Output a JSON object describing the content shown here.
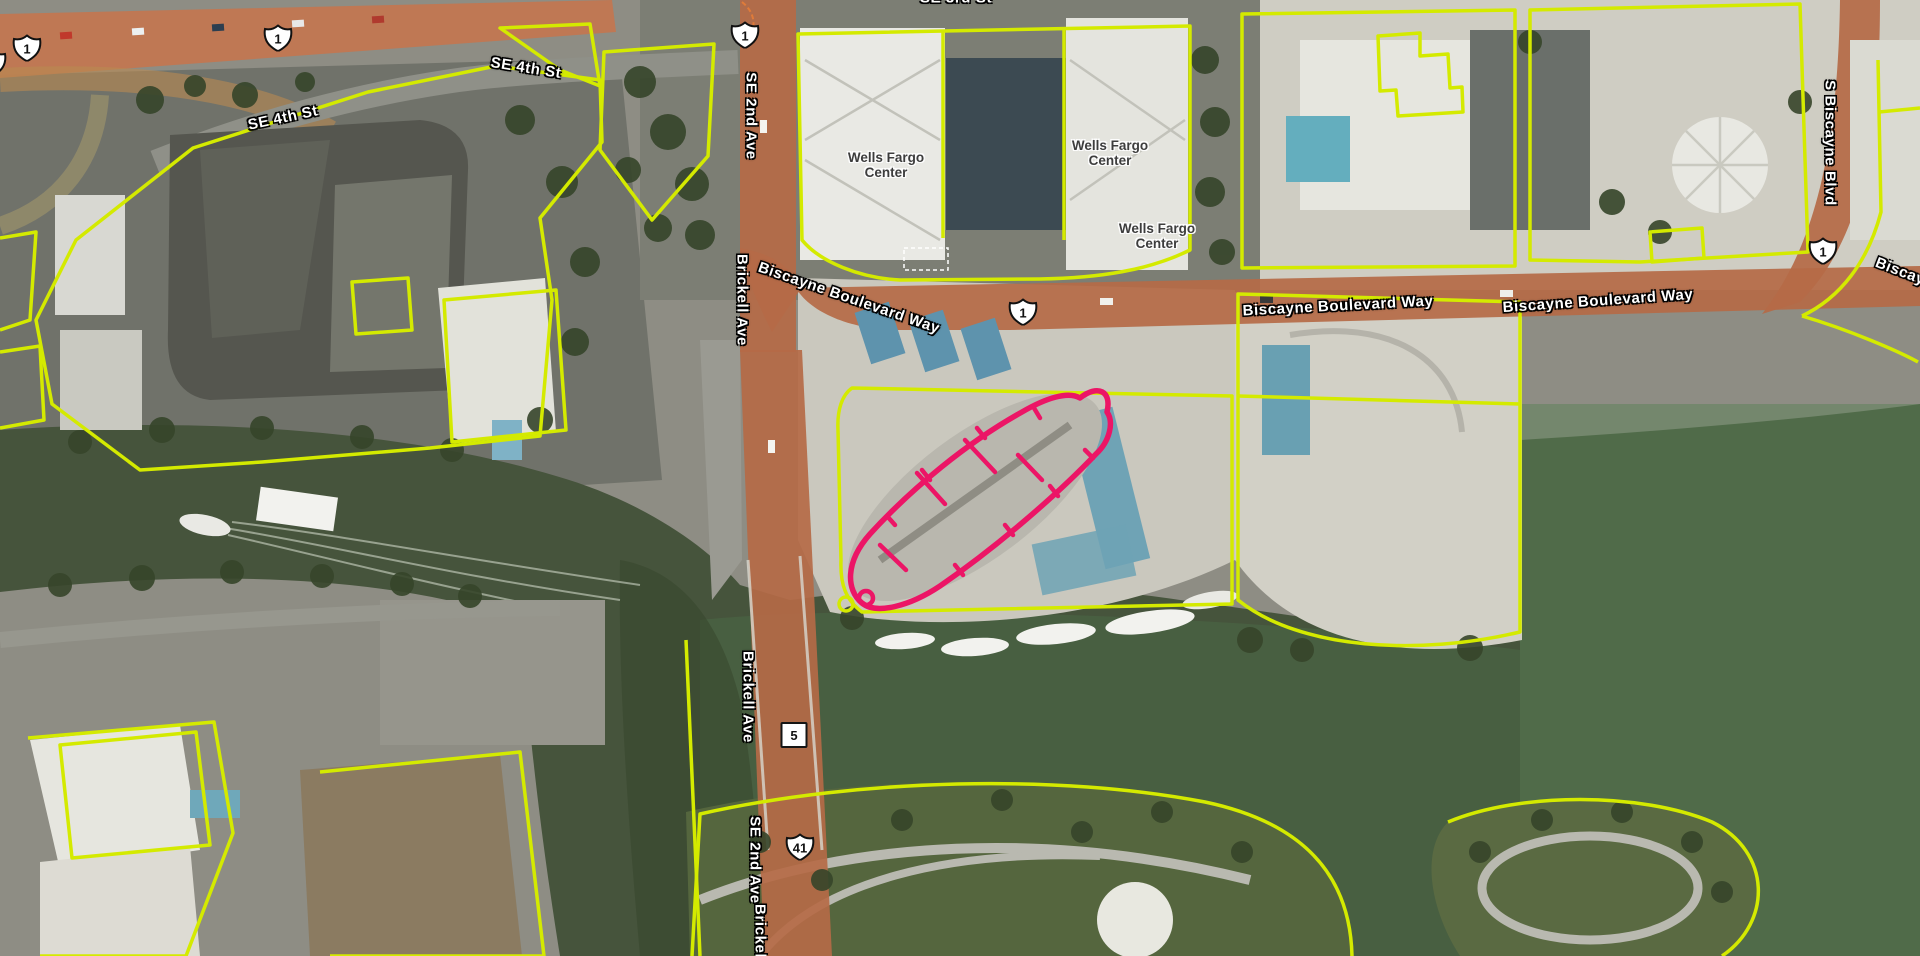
{
  "map": {
    "view_type": "aerial imagery with parcel overlay",
    "colors": {
      "parcel_line": "#d4ea00",
      "selected_parcel_line": "#ec1566",
      "road_overlay": "#b56a46",
      "highway_overlay": "#c4764f",
      "water": "#46543c",
      "street_label_text": "#ffffff",
      "building_label_text": "#3d3d3d"
    },
    "street_labels": [
      {
        "id": "se-3rd-st",
        "text": "SE 3rd St"
      },
      {
        "id": "se-4th-st-west",
        "text": "SE 4th St"
      },
      {
        "id": "se-4th-st-east",
        "text": "SE 4th St"
      },
      {
        "id": "se-2nd-ave-north",
        "text": "SE 2nd Ave"
      },
      {
        "id": "biscayne-blvd-way-1",
        "text": "Biscayne Boulevard Way"
      },
      {
        "id": "biscayne-blvd-way-2",
        "text": "Biscayne Boulevard Way"
      },
      {
        "id": "biscayne-blvd-way-3",
        "text": "Biscayne Boulevard Way"
      },
      {
        "id": "s-biscayne-blvd",
        "text": "S Biscayne Blvd"
      },
      {
        "id": "biscayne-blvd-way-edge",
        "text": "Biscayne Boulevard Way"
      },
      {
        "id": "brickell-ave-north",
        "text": "Brickell Ave"
      },
      {
        "id": "brickell-ave-bridge",
        "text": "Brickell Ave"
      },
      {
        "id": "se-2nd-ave-south",
        "text": "SE 2nd Ave"
      },
      {
        "id": "brickell-ave-bottom",
        "text": "Brickell Ave"
      }
    ],
    "building_labels": [
      {
        "line1": "Wells Fargo",
        "line2": "Center"
      },
      {
        "line1": "Wells Fargo",
        "line2": "Center"
      },
      {
        "line1": "Wells Fargo",
        "line2": "Center"
      }
    ],
    "route_shields": [
      {
        "system": "US Route",
        "number": "1"
      },
      {
        "system": "US Route",
        "number": "1"
      },
      {
        "system": "US Route",
        "number": "1"
      },
      {
        "system": "US Route",
        "number": "1"
      },
      {
        "system": "US Route",
        "number": "1"
      },
      {
        "system": "US Route",
        "number": "1"
      },
      {
        "system": "Florida State Road",
        "number": "5"
      },
      {
        "system": "US Route",
        "number": "41"
      }
    ]
  }
}
